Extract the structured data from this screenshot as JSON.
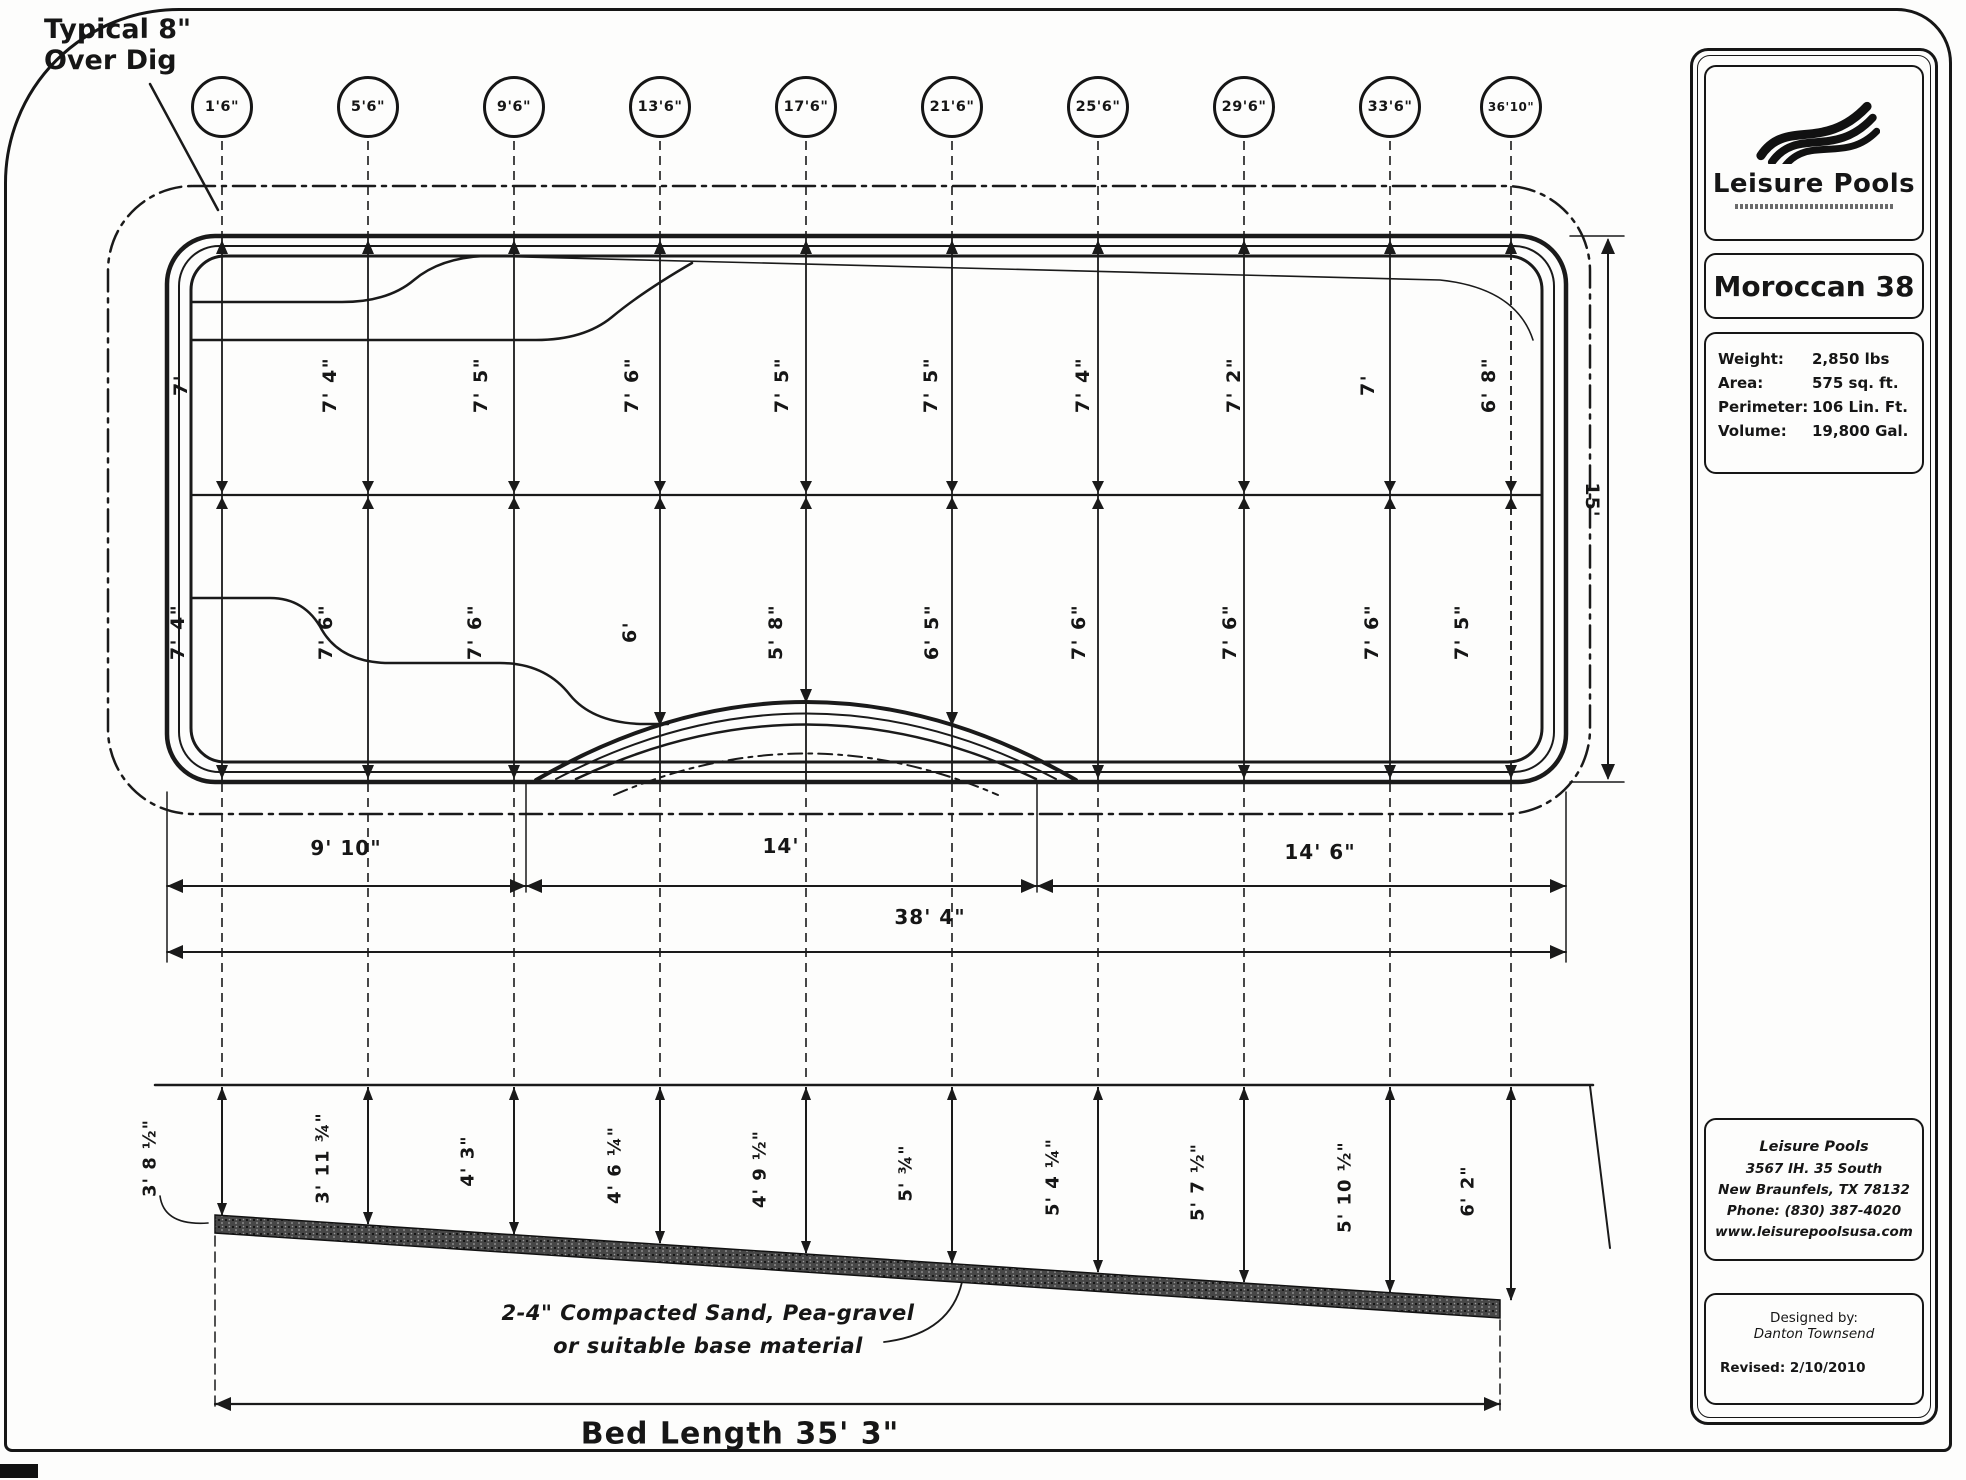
{
  "annotations": {
    "over_dig_line1": "Typical 8\"",
    "over_dig_line2": "Over Dig",
    "base_material_line1": "2-4\" Compacted Sand,  Pea-gravel",
    "base_material_line2": "or suitable base material",
    "bed_length": "Bed Length 35' 3\""
  },
  "stations": [
    "1'6\"",
    "5'6\"",
    "9'6\"",
    "13'6\"",
    "17'6\"",
    "21'6\"",
    "25'6\"",
    "29'6\"",
    "33'6\"",
    "36'10\""
  ],
  "plan": {
    "top_depths": [
      "7'",
      "7' 4\"",
      "7' 5\"",
      "7' 6\"",
      "7' 5\"",
      "7' 5\"",
      "7' 4\"",
      "7' 2\"",
      "7'",
      "6' 8\""
    ],
    "bottom_depths": [
      "7' 4\"",
      "7' 6\"",
      "7' 6\"",
      "6'",
      "5' 8\"",
      "6' 5\"",
      "7' 6\"",
      "7' 6\"",
      "7' 6\"",
      "7' 5\""
    ],
    "width_dim": "15'",
    "bottom_dims": [
      "9' 10\"",
      "14'",
      "14' 6\""
    ],
    "overall_dim": "38' 4\""
  },
  "profile": {
    "depths": [
      "3' 8 ½\"",
      "3' 11 ¾\"",
      "4' 3\"",
      "4' 6 ¼\"",
      "4' 9 ½\"",
      "5' ¾\"",
      "5' 4 ¼\"",
      "5' 7 ½\"",
      "5' 10 ½\"",
      "6' 2\""
    ]
  },
  "sidebar": {
    "brand": "Leisure Pools",
    "model": "Moroccan 38",
    "specs": [
      {
        "label": "Weight:",
        "value": "2,850 lbs"
      },
      {
        "label": "Area:",
        "value": "575 sq. ft."
      },
      {
        "label": "Perimeter:",
        "value": "106 Lin. Ft."
      },
      {
        "label": "Volume:",
        "value": "19,800 Gal."
      }
    ],
    "address": [
      "Leisure Pools",
      "3567 IH. 35 South",
      "New Braunfels, TX 78132",
      "Phone: (830) 387-4020",
      "www.leisurepoolsusa.com"
    ],
    "designed_by_label": "Designed by:",
    "designer": "Danton Townsend",
    "revised": "Revised: 2/10/2010"
  }
}
